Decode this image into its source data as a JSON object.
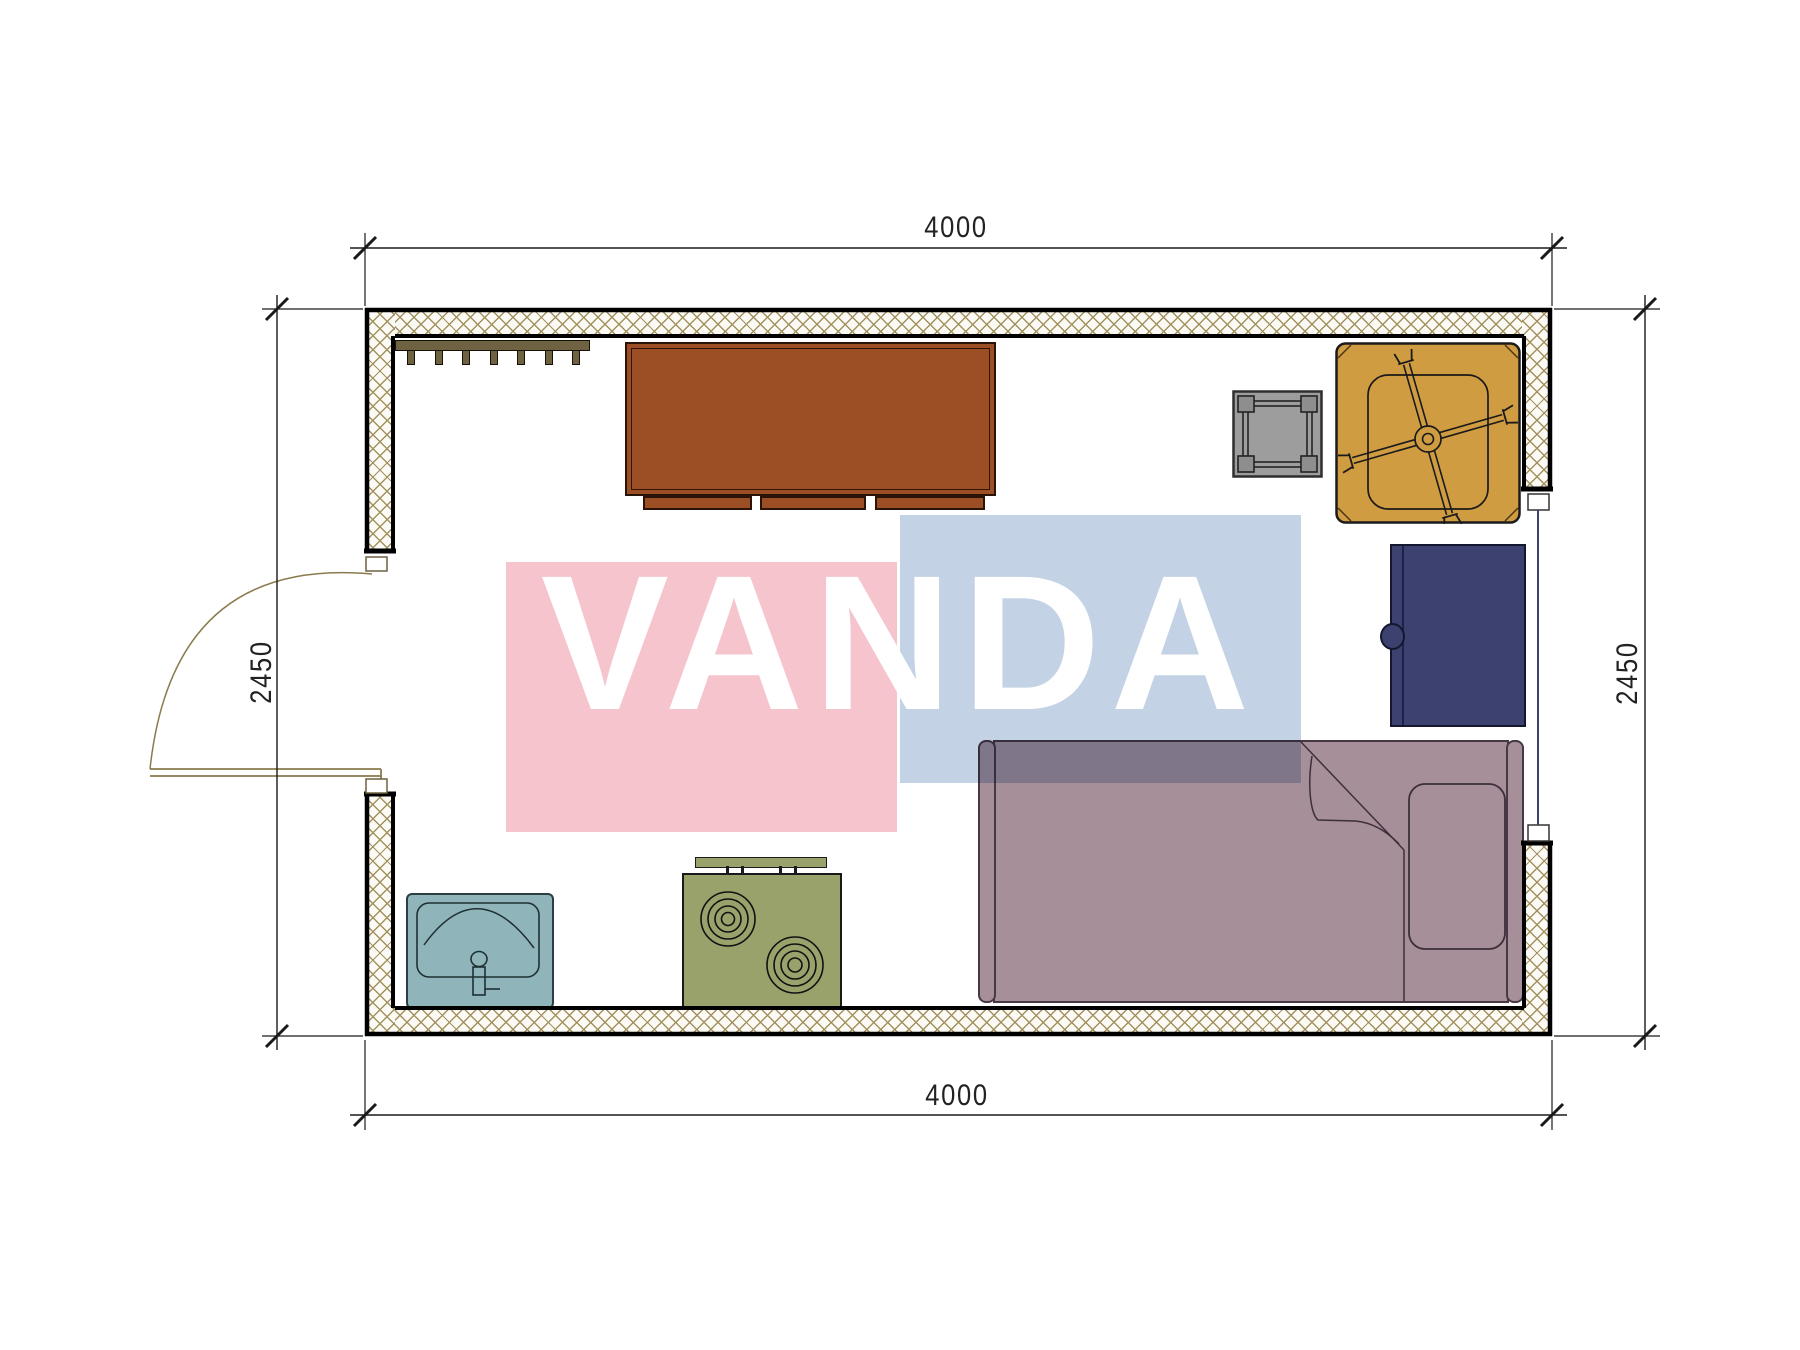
{
  "dimensions": {
    "top_label": "4000",
    "bottom_label": "4000",
    "left_label": "2450",
    "right_label": "2450"
  },
  "watermark": {
    "text": "VANDA",
    "pink_color": "#f5c4cd",
    "blue_color": "#c3d2e4",
    "text_color": "#ffffff"
  },
  "plan": {
    "wall_hatch_color": "#a3915f",
    "wall_outline_color": "#000000",
    "door": "hinged swing door in left wall",
    "window": "window in right wall",
    "window_glazing_color": "#3c4170",
    "furniture": {
      "coat_rack": "wall coat rack with hooks",
      "desk": "desk cabinet",
      "desk_color": "#9c4e24",
      "side_table": "small square table",
      "side_table_color": "#9d9d9d",
      "office_chair": "swivel office chair",
      "office_chair_color": "#d09c42",
      "nightstand": "nightstand with door knob",
      "nightstand_color": "#3c416f",
      "bed": "single bed with pillow and folded blanket",
      "bed_color": "#a78f99",
      "sink": "wash basin with faucet",
      "sink_color": "#8fb5bb",
      "stove": "two-burner stove",
      "stove_color": "#9aa26c"
    }
  }
}
